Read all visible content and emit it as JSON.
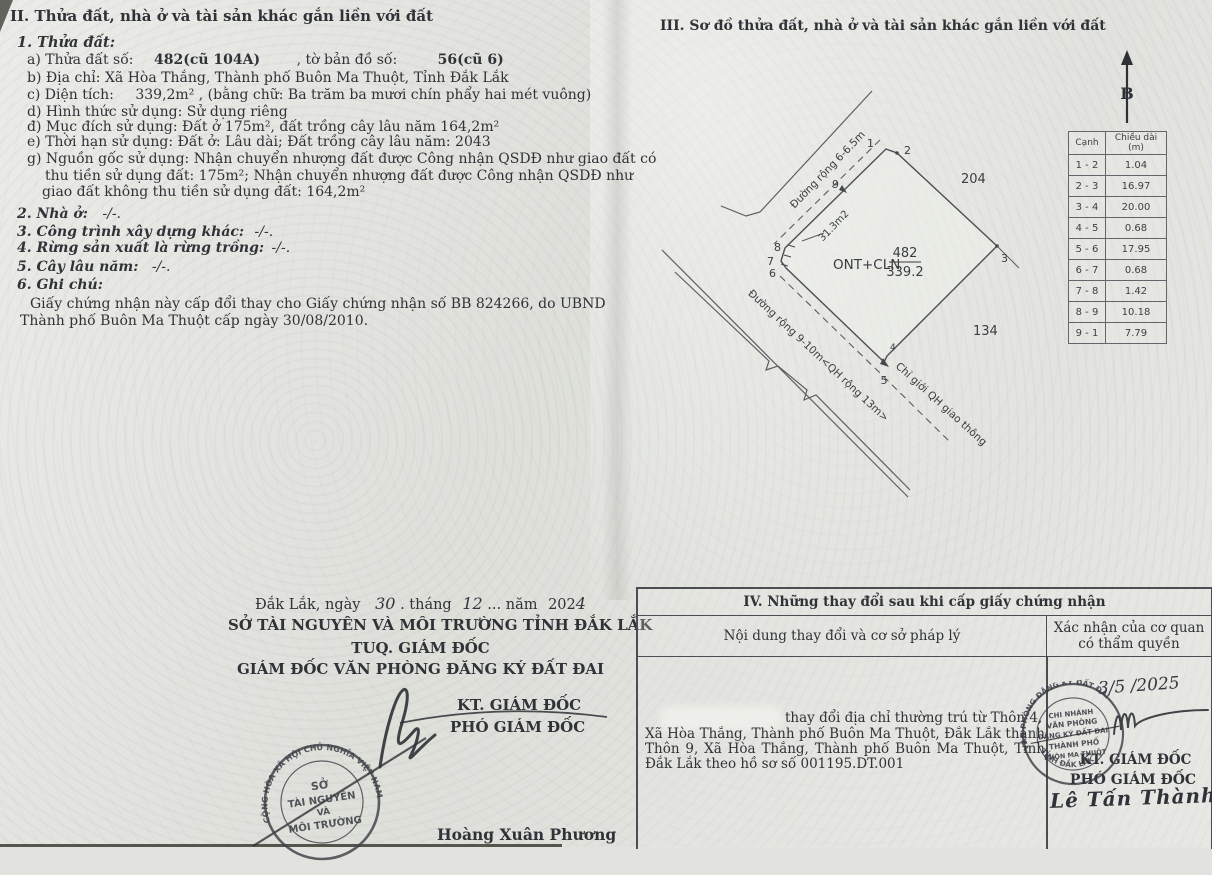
{
  "colors": {
    "paper": "#e2e3de",
    "ink": "#2f3237",
    "line": "#55585e",
    "stamp_ink": "#3d4046"
  },
  "section2": {
    "title": "II. Thửa đất, nhà ở và tài sản khác gắn liền với đất",
    "item1": "1. Thửa đất:",
    "a_label": "a) Thửa đất số:",
    "a_value": "482(cũ 104A)",
    "a_mid": ", tờ bản đồ số:",
    "a_value2": "56(cũ 6)",
    "b": "b) Địa chỉ:  Xã Hòa Thắng, Thành phố Buôn Ma Thuột, Tỉnh Đắk Lắk",
    "c_label": "c) Diện tích:",
    "c_value": "339,2m²",
    "c_rest": ", (bằng chữ: Ba trăm ba mươi chín phẩy hai mét vuông)",
    "d": "d) Hình thức sử dụng:  Sử dụng riêng",
    "dd": "đ) Mục đích sử dụng:  Đất ở 175m², đất trồng cây lâu năm 164,2m²",
    "e": "e) Thời hạn sử dụng:  Đất ở: Lâu dài; Đất trồng cây lâu năm: 2043",
    "g1": "g) Nguồn gốc sử dụng: Nhận chuyển nhượng đất được Công nhận QSDĐ như giao đất có",
    "g2": "thu tiền sử dụng đất: 175m²; Nhận chuyển nhượng đất được Công nhận QSDĐ như",
    "g3": "giao đất không thu tiền sử dụng đất: 164,2m²",
    "item2": "2. Nhà ở:",
    "item2_v": "-/-.",
    "item3": "3. Công trình xây dựng khác:",
    "item3_v": "-/-.",
    "item4": "4. Rừng sản xuất là rừng trồng:",
    "item4_v": "-/-.",
    "item5": "5. Cây lâu năm:",
    "item5_v": "-/-.",
    "item6": "6. Ghi chú:",
    "note1": "Giấy chứng nhận này cấp đổi thay cho Giấy chứng nhận số BB 824266, do UBND",
    "note2": "Thành phố Buôn Ma Thuột cấp ngày 30/08/2010."
  },
  "sign_left": {
    "d_pre": "Đắk Lắk, ngày",
    "d_day": "30",
    "d_m1": ". tháng",
    "d_month": "12",
    "d_m2": "... năm",
    "d_year_p": "202",
    "d_year_h": "4",
    "org1": "SỞ TÀI NGUYÊN VÀ MÔI TRƯỜNG TỈNH ĐẮK LẮK",
    "org2": "TUQ. GIÁM ĐỐC",
    "org3": "GIÁM ĐỐC VĂN PHÒNG ĐĂNG KÝ ĐẤT ĐAI",
    "kt": "KT. GIÁM ĐỐC",
    "pho": "PHÓ GIÁM ĐỐC",
    "name": "Hoàng Xuân Phương",
    "stamp": {
      "ring": "CỘNG HÒA XÃ HỘI CHỦ NGHĨA VIỆT NAM",
      "c1": "SỞ",
      "c2": "TÀI NGUYÊN",
      "c3": "VÀ",
      "c4": "MÔI TRƯỜNG"
    }
  },
  "section3": {
    "title": "III. Sơ đồ thửa đất, nhà ở và tài sản khác gắn liền với đất",
    "north": "B",
    "diagram": {
      "road_top": "Đường rộng 6-6.5m",
      "strip_area": "31.3m2",
      "parcel_code": "ONT+CLN",
      "parcel_number": "482",
      "parcel_area": "339.2",
      "adj_top": "204",
      "adj_bottom": "134",
      "road_bottom": "Đường rộng 9-10m<QH rộng 13m>",
      "boundary_label": "Chỉ giới QH giao thông",
      "v": [
        "1",
        "2",
        "3",
        "4",
        "5",
        "6",
        "7",
        "8",
        "9"
      ]
    },
    "edge_table": {
      "col1": "Cạnh",
      "col2": "Chiều dài (m)",
      "rows": [
        [
          "1 - 2",
          "1.04"
        ],
        [
          "2 - 3",
          "16.97"
        ],
        [
          "3 - 4",
          "20.00"
        ],
        [
          "4 - 5",
          "0.68"
        ],
        [
          "5 - 6",
          "17.95"
        ],
        [
          "6 - 7",
          "0.68"
        ],
        [
          "7 - 8",
          "1.42"
        ],
        [
          "8 - 9",
          "10.18"
        ],
        [
          "9 - 1",
          "7.79"
        ]
      ]
    }
  },
  "section4": {
    "title": "IV. Những thay đổi sau khi cấp giấy chứng nhận",
    "col1": "Nội dung thay đổi và cơ sở pháp lý",
    "col2a": "Xác nhận của cơ quan",
    "col2b": "có thẩm quyền",
    "line1": "thay đổi địa chỉ thường trú từ Thôn 4,",
    "line2": "Xã Hòa Thắng, Thành phố Buôn Ma Thuột, Đắk Lắk thành",
    "line3": "Thôn 9, Xã Hòa Thắng, Thành phố Buôn Ma Thuột, Tỉnh",
    "line4": "Đắk Lắk theo hồ sơ số 001195.DT.001",
    "date_hand": "3/5 /2025",
    "kt": "KT. GIÁM ĐỐC",
    "pho": "PHÓ GIÁM ĐỐC",
    "name": "Lê Tấn Thành",
    "stamp": {
      "ring_top": "VĂN PHÒNG ĐĂNG KÝ ĐẤT ĐAI",
      "ring_bottom": "TỈNH ĐẮK LẮK",
      "c1": "CHI NHÁNH",
      "c2": "VĂN PHÒNG",
      "c3": "ĐĂNG KÝ ĐẤT ĐAI",
      "c4": "THÀNH PHỐ",
      "c5": "BUÔN MA THUỘT"
    }
  }
}
